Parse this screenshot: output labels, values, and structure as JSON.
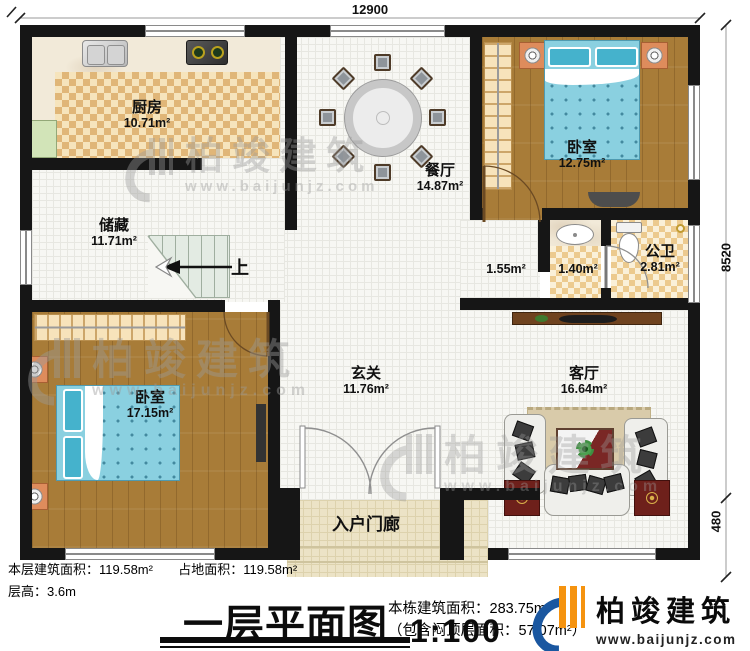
{
  "dimensions": {
    "top": "12900",
    "right_upper": "8520",
    "right_lower": "480"
  },
  "rooms": {
    "kitchen": {
      "name": "厨房",
      "area": "10.71m²"
    },
    "dining": {
      "name": "餐厅",
      "area": "14.87m²"
    },
    "bedroom_top": {
      "name": "卧室",
      "area": "12.75m²"
    },
    "storage": {
      "name": "储藏",
      "area": "11.71m²"
    },
    "lobby": {
      "area": "1.55m²"
    },
    "washbasin": {
      "area": "1.40m²"
    },
    "bathroom": {
      "name": "公卫",
      "area": "2.81m²"
    },
    "bedroom_bottom": {
      "name": "卧室",
      "area": "17.15m²"
    },
    "foyer": {
      "name": "玄关",
      "area": "11.76m²"
    },
    "living": {
      "name": "客厅",
      "area": "16.64m²"
    },
    "porch": {
      "name": "入户门廊"
    }
  },
  "stairs": {
    "direction_label": "上"
  },
  "annotations": {
    "floor_area": "本层建筑面积：119.58m²",
    "land_area": "占地面积：119.58m²",
    "floor_height": "层高：3.6m",
    "building_area": "本栋建筑面积：283.75m²",
    "attic_area": "（包含闷顶层面积：57.07m²）"
  },
  "title_block": {
    "title": "一层平面图",
    "scale": "1:100"
  },
  "brand": {
    "name": "柏竣建筑",
    "website": "www.baijunjz.com"
  },
  "colors": {
    "wall": "#161616",
    "wood": "#a87c38",
    "checker": "#e0b678",
    "bed_blue": "#8ad0e0",
    "logo_blue": "#1a57a0",
    "logo_orange": "#f5930f"
  }
}
